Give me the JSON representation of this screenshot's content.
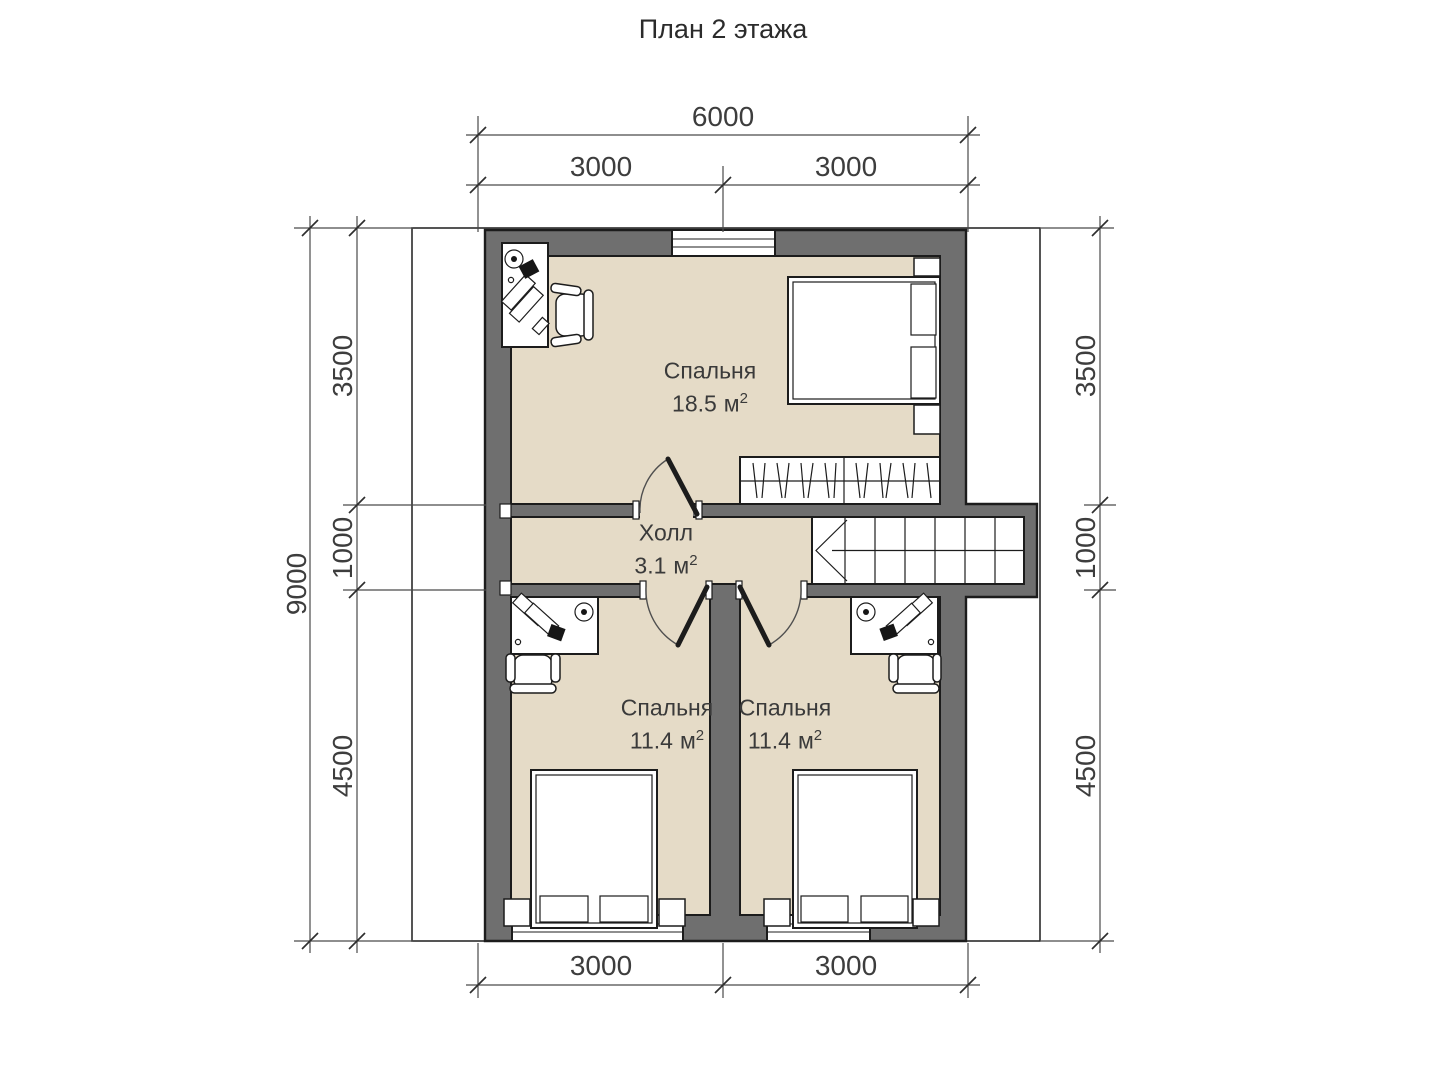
{
  "title": "План 2 этажа",
  "rooms": [
    {
      "name": "Спальня",
      "area": "18.5",
      "unit": "м",
      "sup": "2"
    },
    {
      "name": "Холл",
      "area": "3.1",
      "unit": "м",
      "sup": "2"
    },
    {
      "name": "Спальня",
      "area": "11.4",
      "unit": "м",
      "sup": "2"
    },
    {
      "name": "Спальня",
      "area": "11.4",
      "unit": "м",
      "sup": "2"
    }
  ],
  "dimensions": {
    "top": {
      "total": "6000",
      "segments": [
        "3000",
        "3000"
      ]
    },
    "bottom": {
      "segments": [
        "3000",
        "3000"
      ]
    },
    "left": {
      "total": "9000",
      "segments": [
        "3500",
        "1000",
        "4500"
      ]
    },
    "right": {
      "segments": [
        "3500",
        "1000",
        "4500"
      ]
    }
  },
  "colors": {
    "wall": "#6f6f6f",
    "floor": "#e5dbc7",
    "outline": "#1c1c1c",
    "dimension_line": "#4a4a4a",
    "text": "#3a3a3a"
  }
}
